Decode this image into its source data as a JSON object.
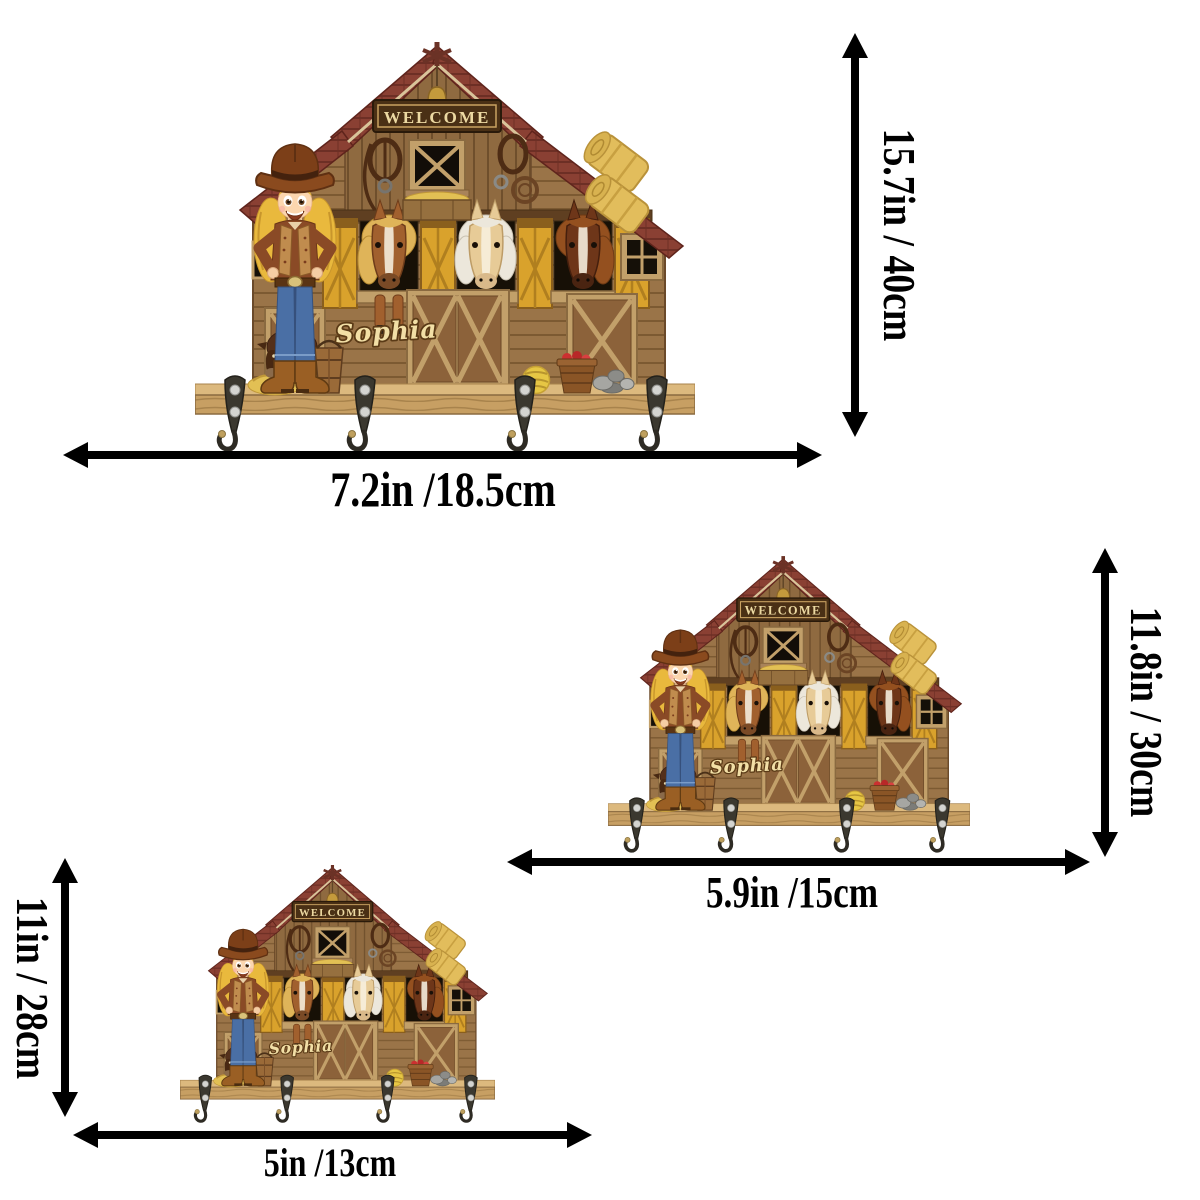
{
  "product": {
    "welcome_sign": "WELCOME",
    "personalized_name": "Sophia",
    "horses": [
      "chestnut-horse-blonde-mane",
      "palomino-horse-white-mane",
      "dark-bay-horse"
    ],
    "hooks_per_barn": 4
  },
  "sizes": [
    {
      "label": "large",
      "width": "7.2in /18.5cm",
      "height": "15.7in / 40cm"
    },
    {
      "label": "medium",
      "width": "5.9in /15cm",
      "height": "11.8in / 30cm"
    },
    {
      "label": "small",
      "width": "5in /13cm",
      "height": "11in / 28cm"
    }
  ],
  "colors": {
    "background": "#ffffff",
    "arrow": "#000000",
    "roof_red": "#8a4033",
    "barn_wood": "#9a7448",
    "gable_wood": "#8f6a40",
    "door_yellow": "#d9a22c",
    "shelf_wood": "#c79f63",
    "hook_metal": "#3b382f",
    "sign_board": "#4a3015",
    "sign_text": "#ecd9a2",
    "name_text": "#f2dfa6",
    "hay_yellow": "#e2c054"
  }
}
